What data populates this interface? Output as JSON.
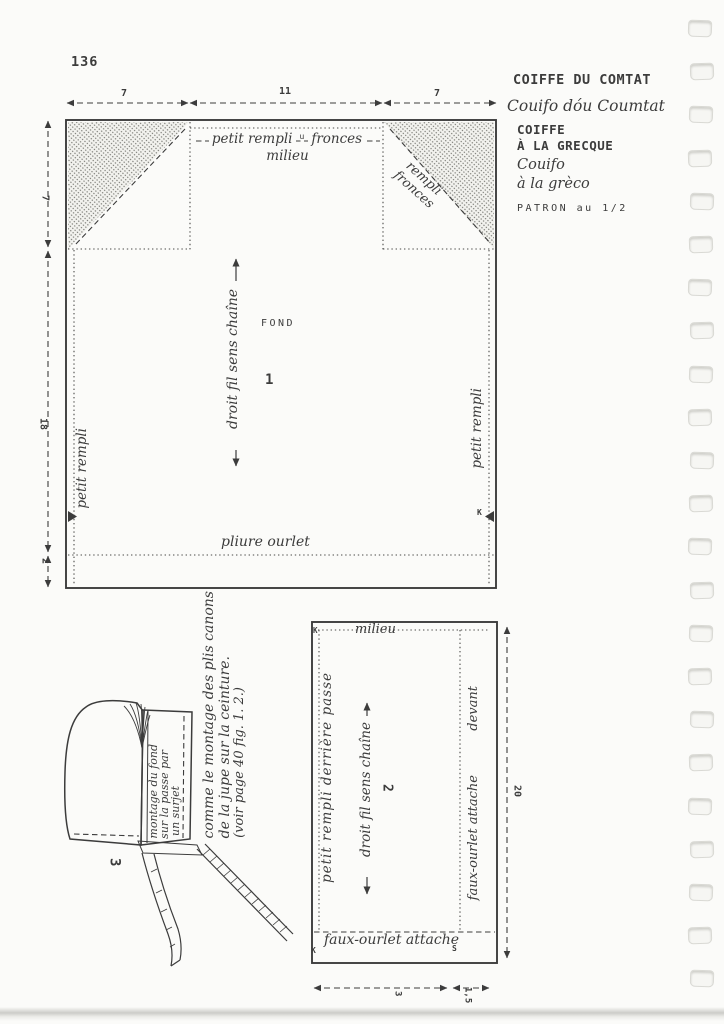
{
  "page": {
    "number": "136"
  },
  "header": {
    "title": "COIFFE DU COMTAT",
    "subtitle": "Couifo dóu Coumtat",
    "title2_line1": "COIFFE",
    "title2_line2": "À LA GRECQUE",
    "subtitle2_line1": "Couifo",
    "subtitle2_line2": "à la grèco",
    "scale_note": "PATRON au 1/2"
  },
  "fig1": {
    "number": "1",
    "piece_name": "FOND",
    "top_measures": [
      "7",
      "11",
      "7"
    ],
    "left_measures": [
      "7",
      "18",
      "2"
    ],
    "top_label_left": "petit rempli",
    "top_label_mark": "u",
    "top_label_right": "fronces",
    "milieu": "milieu",
    "corner_line1": "rempli",
    "corner_line2": "fronces",
    "grainline": "droit fil sens chaîne",
    "side_left": "petit rempli",
    "side_right": "petit rempli",
    "hem": "pliure ourlet",
    "mark_right": "K"
  },
  "fig2": {
    "number": "2",
    "milieu": "milieu",
    "left_label": "petit rempli derrière passe",
    "grainline": "droit fil sens chaîne",
    "right_label_bottom": "faux-ourlet attache",
    "right_label_top": "devant",
    "bottom_label": "faux-ourlet attache",
    "mark_top_left": "K",
    "mark_bottom_left": "K",
    "mark_bottom_mid": "S",
    "measure_right": "20",
    "measure_bottom_long": "3",
    "measure_bottom_short": "1,5"
  },
  "fig3": {
    "number": "3",
    "band_line1": "montage du fond",
    "band_line2": "sur la passe par",
    "band_line3": "un surjet",
    "note_line1": "comme le montage des plis canons",
    "note_line2": "de la jupe sur la ceinture.",
    "note_line3": "(voir page 40  fig. 1. 2.)"
  },
  "binding": {
    "hole_count": 23
  }
}
